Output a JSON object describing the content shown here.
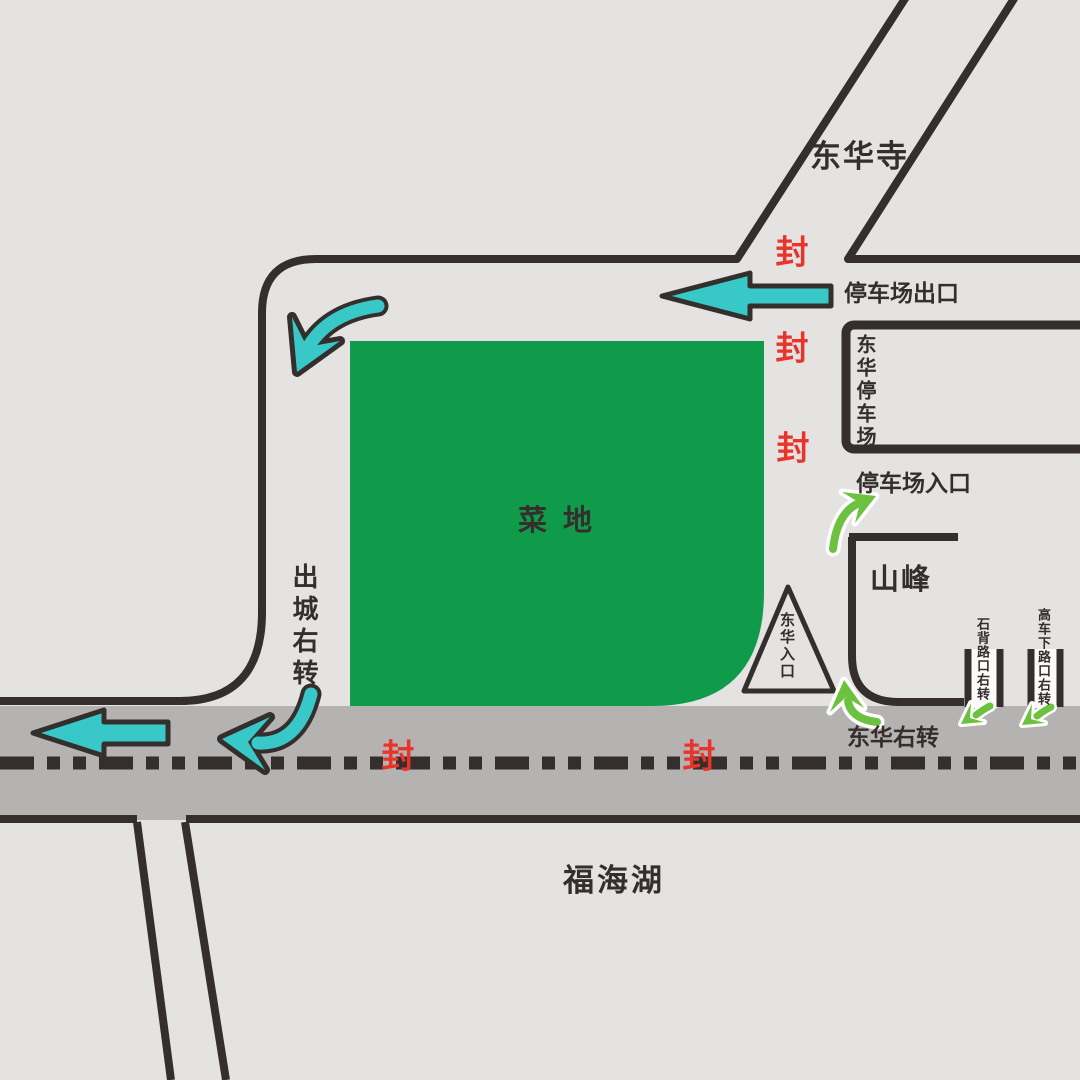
{
  "colors": {
    "bg": "#e4e3e2",
    "road": "#b5b3b2",
    "line": "#342e2c",
    "text": "#342e2c",
    "field-green": "#0f9b4a",
    "cyan": "#38c8c7",
    "green-arrow": "#6cc13e",
    "red": "#e8342b",
    "side-road": "#fbfbfa"
  },
  "labels": {
    "temple": "东华寺",
    "parking_exit": "停车场出口",
    "parking_lot_vertical": "东华停车场",
    "parking_entrance": "停车场入口",
    "mountain": "山峰",
    "field": "菜 地",
    "exit_city_right_turn": "出城右转",
    "entrance_triangle": "东华入口",
    "donghua_right_turn": "东华右转",
    "side_street_1": "石背路口右转",
    "side_street_2": "高车下路口右转",
    "lake": "福海湖",
    "closed": "封"
  }
}
